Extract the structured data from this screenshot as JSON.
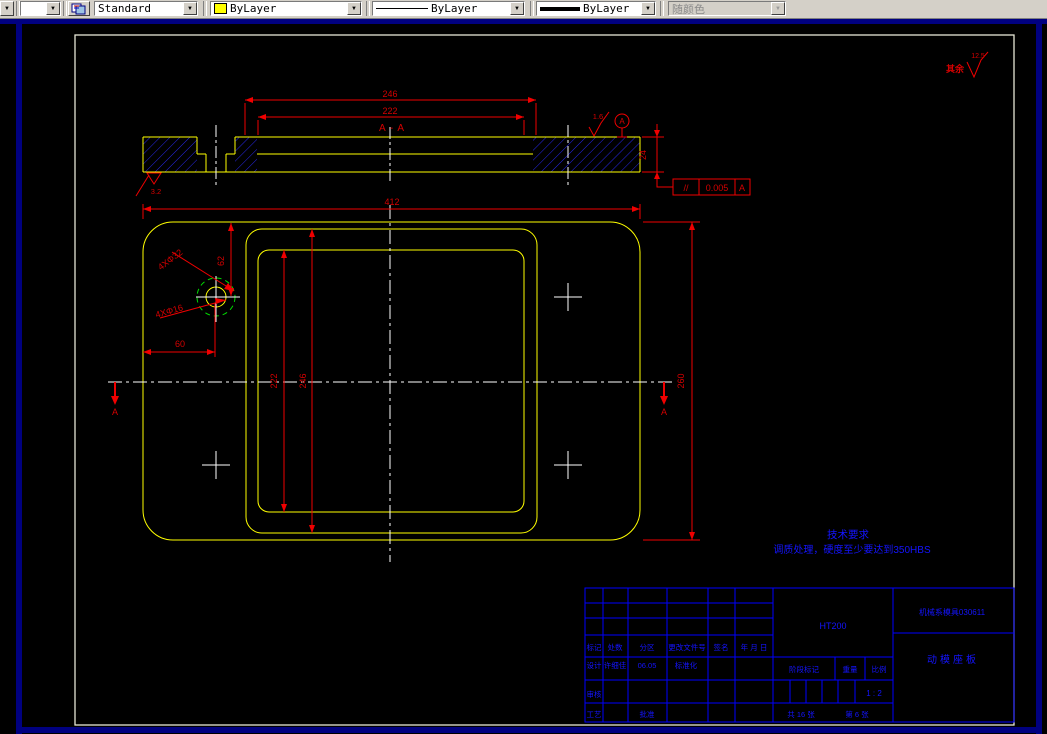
{
  "toolbar": {
    "style_value": "Standard",
    "color_value": "ByLayer",
    "color_swatch": "#ffff00",
    "linetype_value": "ByLayer",
    "lineweight_value": "ByLayer",
    "plotstyle_value": "随颜色",
    "dropdown_glyph": "▼"
  },
  "annotations": {
    "surface_default_label": "其余",
    "surface_default_value": "12.5",
    "surface_top": "1.6",
    "surface_bottom": "3.2",
    "section_title": "A - A",
    "datum_label": "A",
    "fcf_symbol": "//",
    "fcf_tolerance": "0.005",
    "fcf_datum": "A",
    "cut_label_left": "A",
    "cut_label_right": "A",
    "tech_title": "技术要求",
    "tech_line": "调质处理，硬度至少要达到350HBS"
  },
  "dimensions": {
    "pocket_width": "246",
    "opening_width": "222",
    "thickness": "24",
    "plate_width": "412",
    "hole_offset_y": "62",
    "hole_offset_x": "60",
    "counterbore_note": "4XΦ32",
    "hole_note": "4XΦ16",
    "opening_height": "222",
    "pocket_height": "246",
    "plate_height": "260"
  },
  "titleblock": {
    "material": "HT200",
    "drawing_no": "机械系模具030611",
    "part_name": "动模座板",
    "header": {
      "mark": "标记",
      "count": "处数",
      "zone": "分区",
      "change_file_no": "更改文件号",
      "signature": "签名",
      "date": "年 月 日"
    },
    "design_label": "设计",
    "designer": "许细佳",
    "design_date": "06.05",
    "standardization_label": "标准化",
    "review_label": "审核",
    "process_label": "工艺",
    "approve_label": "批准",
    "stage_label": "阶段标记",
    "weight_label": "重量",
    "scale_label": "比例",
    "scale_value": "1 : 2",
    "sheet_total": "共 16 张",
    "sheet_current": "第 6 张"
  }
}
